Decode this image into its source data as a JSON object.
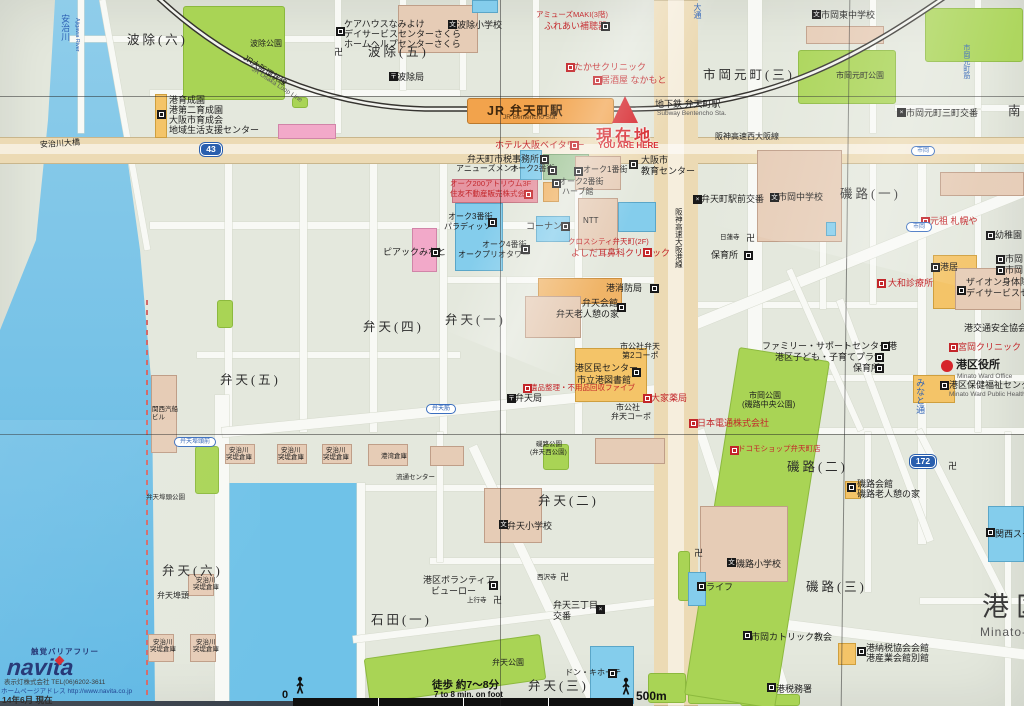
{
  "app": {
    "description": "Photographed local area guide map of JR Bentencho Station, Minato Ward, Osaka"
  },
  "marker": {
    "label": "現在地",
    "label_en": "YOU ARE HERE"
  },
  "station": {
    "name": "JR 弁天町駅",
    "name_en": "JR Bentencho Sta."
  },
  "districts": [
    {
      "t": "波除(六)",
      "x": 127,
      "y": 33
    },
    {
      "t": "波除(五)",
      "x": 368,
      "y": 45
    },
    {
      "t": "市岡元町(三)",
      "x": 703,
      "y": 68
    },
    {
      "t": "弁天(四)",
      "x": 363,
      "y": 320
    },
    {
      "t": "弁天(一)",
      "x": 445,
      "y": 313
    },
    {
      "t": "弁天(五)",
      "x": 220,
      "y": 373
    },
    {
      "t": "弁天(六)",
      "x": 162,
      "y": 564
    },
    {
      "t": "弁天(二)",
      "x": 538,
      "y": 494
    },
    {
      "t": "弁天(三)",
      "x": 528,
      "y": 679
    },
    {
      "t": "石田(一)",
      "x": 371,
      "y": 613
    },
    {
      "t": "磯路(一)",
      "x": 840,
      "y": 187
    },
    {
      "t": "磯路(二)",
      "x": 787,
      "y": 460
    },
    {
      "t": "磯路(三)",
      "x": 806,
      "y": 580
    },
    {
      "t": "南",
      "x": 1008,
      "y": 104
    }
  ],
  "ward": {
    "name": "港区",
    "name_en": "Minato-",
    "x": 982,
    "y": 592,
    "ex": 980,
    "ey": 626
  },
  "pois": [
    {
      "t": "港育成園",
      "x": 169,
      "y": 95
    },
    {
      "t": "港第二育成園",
      "x": 169,
      "y": 105
    },
    {
      "t": "大阪市育成会",
      "x": 169,
      "y": 115
    },
    {
      "t": "地域生活支援センター",
      "x": 169,
      "y": 125
    },
    {
      "t": "安治川大橋",
      "x": 40,
      "y": 140,
      "c": "s",
      "rot": -4
    },
    {
      "t": "波除公園",
      "x": 250,
      "y": 40,
      "c": "s"
    },
    {
      "t": "ケアハウスなみよけ",
      "x": 344,
      "y": 19
    },
    {
      "t": "デイサービスセンターさくら",
      "x": 344,
      "y": 29
    },
    {
      "t": "ホームヘルプセンターさくら",
      "x": 344,
      "y": 39
    },
    {
      "t": "波除小学校",
      "x": 457,
      "y": 20
    },
    {
      "t": "波除局",
      "x": 397,
      "y": 72
    },
    {
      "t": "アミューズMAKI(3階)",
      "x": 536,
      "y": 11,
      "c": "rs"
    },
    {
      "t": "ふれあい補聴器",
      "x": 544,
      "y": 21,
      "c": "r"
    },
    {
      "t": "たかせクリニック",
      "x": 574,
      "y": 62,
      "c": "r"
    },
    {
      "t": "居酒屋 なかもと",
      "x": 601,
      "y": 75,
      "c": "r"
    },
    {
      "t": "市岡東中学校",
      "x": 821,
      "y": 10
    },
    {
      "t": "市岡元町公園",
      "x": 836,
      "y": 72,
      "c": "s"
    },
    {
      "t": "市岡元町三町交番",
      "x": 906,
      "y": 108
    },
    {
      "t": "地下鉄 弁天町駅",
      "x": 655,
      "y": 99
    },
    {
      "t": "Subway Bentencho Sta.",
      "x": 657,
      "y": 110,
      "c": "e"
    },
    {
      "t": "阪神高速西大阪線",
      "x": 715,
      "y": 133,
      "c": "s"
    },
    {
      "t": "ホテル大阪ベイタワー",
      "x": 495,
      "y": 140,
      "c": "r"
    },
    {
      "t": "弁天町市税事務所",
      "x": 467,
      "y": 154
    },
    {
      "t": "アニューズメント",
      "x": 456,
      "y": 165,
      "c": "s"
    },
    {
      "t": "オーク2番街",
      "x": 510,
      "y": 165,
      "c": "s"
    },
    {
      "t": "オーク1番街",
      "x": 583,
      "y": 166,
      "c": "s"
    },
    {
      "t": "大阪市",
      "x": 641,
      "y": 155
    },
    {
      "t": "教育センター",
      "x": 641,
      "y": 166
    },
    {
      "t": "オーク200アトリウム3F",
      "x": 450,
      "y": 180,
      "c": "rs"
    },
    {
      "t": "住友不動産販売株式会社",
      "x": 450,
      "y": 190,
      "c": "rs"
    },
    {
      "t": "オーク2番街",
      "x": 559,
      "y": 178,
      "c": "s"
    },
    {
      "t": "ハーブ館",
      "x": 562,
      "y": 188,
      "c": "s"
    },
    {
      "t": "オーク3番街",
      "x": 448,
      "y": 213,
      "c": "s"
    },
    {
      "t": "パラディッソ",
      "x": 444,
      "y": 223,
      "c": "s"
    },
    {
      "t": "コーナン",
      "x": 526,
      "y": 221
    },
    {
      "t": "NTT",
      "x": 583,
      "y": 217,
      "c": "s"
    },
    {
      "t": "オーク4番街",
      "x": 482,
      "y": 241,
      "c": "s"
    },
    {
      "t": "オークプリオタワー",
      "x": 458,
      "y": 251,
      "c": "s"
    },
    {
      "t": "クロスシティ弁天町(2F)",
      "x": 568,
      "y": 238,
      "c": "rs"
    },
    {
      "t": "よしだ耳鼻科クリニック",
      "x": 571,
      "y": 248,
      "c": "r"
    },
    {
      "t": "ピアックみなと",
      "x": 383,
      "y": 247
    },
    {
      "t": "弁天町駅前交番",
      "x": 701,
      "y": 194
    },
    {
      "t": "市岡中学校",
      "x": 778,
      "y": 192
    },
    {
      "t": "日蓮寺",
      "x": 720,
      "y": 234,
      "c": "ss"
    },
    {
      "t": "保育所",
      "x": 711,
      "y": 250
    },
    {
      "t": "元祖 札幌や",
      "x": 930,
      "y": 216,
      "c": "r"
    },
    {
      "t": "幼稚園",
      "x": 995,
      "y": 230
    },
    {
      "t": "市岡",
      "x": 1005,
      "y": 254
    },
    {
      "t": "市岡",
      "x": 1005,
      "y": 265
    },
    {
      "t": "港居",
      "x": 940,
      "y": 262
    },
    {
      "t": "ザイオン身体障害",
      "x": 966,
      "y": 277
    },
    {
      "t": "デイサービスセ",
      "x": 966,
      "y": 288
    },
    {
      "t": "大和診療所",
      "x": 888,
      "y": 278,
      "c": "r"
    },
    {
      "t": "港交通安全協会",
      "x": 964,
      "y": 323
    },
    {
      "t": "宮岡クリニック",
      "x": 958,
      "y": 342,
      "c": "r"
    },
    {
      "t": "港区役所",
      "x": 956,
      "y": 359,
      "c": "b11"
    },
    {
      "t": "Minato Ward Office",
      "x": 957,
      "y": 373,
      "c": "e"
    },
    {
      "t": "港区保健福祉センター",
      "x": 949,
      "y": 380
    },
    {
      "t": "Minato Ward Public Health and Welf",
      "x": 949,
      "y": 391,
      "c": "e"
    },
    {
      "t": "港消防局",
      "x": 606,
      "y": 283
    },
    {
      "t": "弁天会館",
      "x": 582,
      "y": 298
    },
    {
      "t": "弁天老人憩の家",
      "x": 556,
      "y": 309
    },
    {
      "t": "市公社弁天",
      "x": 620,
      "y": 343,
      "c": "s"
    },
    {
      "t": "第2コーポ",
      "x": 622,
      "y": 352,
      "c": "s"
    },
    {
      "t": "港区民センター",
      "x": 575,
      "y": 363
    },
    {
      "t": "市立港図書館",
      "x": 577,
      "y": 375
    },
    {
      "t": "遺品整理・不用品回収ファイブ",
      "x": 530,
      "y": 384,
      "c": "rs"
    },
    {
      "t": "弁天局",
      "x": 515,
      "y": 393
    },
    {
      "t": "大家薬局",
      "x": 651,
      "y": 393,
      "c": "r"
    },
    {
      "t": "市公社",
      "x": 616,
      "y": 404,
      "c": "s"
    },
    {
      "t": "弁天コーポ",
      "x": 611,
      "y": 413,
      "c": "s"
    },
    {
      "t": "日本電通株式会社",
      "x": 697,
      "y": 418,
      "c": "r"
    },
    {
      "t": "ドコモショップ弁天町店",
      "x": 738,
      "y": 445,
      "c": "rs"
    },
    {
      "t": "ファミリー・サポートセンター港",
      "x": 762,
      "y": 341
    },
    {
      "t": "港区子ども・子育てプラザ",
      "x": 775,
      "y": 352
    },
    {
      "t": "保育所",
      "x": 853,
      "y": 363
    },
    {
      "t": "市岡公園",
      "x": 749,
      "y": 392,
      "c": "s"
    },
    {
      "t": "(磯路中央公園)",
      "x": 742,
      "y": 401,
      "c": "s"
    },
    {
      "t": "関西汽船",
      "x": 152,
      "y": 406,
      "c": "ss"
    },
    {
      "t": "ビル",
      "x": 152,
      "y": 414,
      "c": "ss"
    },
    {
      "t": "安治川",
      "x": 229,
      "y": 447,
      "c": "ss"
    },
    {
      "t": "突堤倉庫",
      "x": 226,
      "y": 454,
      "c": "ss"
    },
    {
      "t": "安治川",
      "x": 281,
      "y": 447,
      "c": "ss"
    },
    {
      "t": "突堤倉庫",
      "x": 278,
      "y": 454,
      "c": "ss"
    },
    {
      "t": "安治川",
      "x": 326,
      "y": 447,
      "c": "ss"
    },
    {
      "t": "突堤倉庫",
      "x": 323,
      "y": 454,
      "c": "ss"
    },
    {
      "t": "安治川",
      "x": 196,
      "y": 577,
      "c": "ss"
    },
    {
      "t": "突堤倉庫",
      "x": 193,
      "y": 584,
      "c": "ss"
    },
    {
      "t": "安治川",
      "x": 153,
      "y": 639,
      "c": "ss"
    },
    {
      "t": "突堤倉庫",
      "x": 150,
      "y": 646,
      "c": "ss"
    },
    {
      "t": "安治川",
      "x": 196,
      "y": 639,
      "c": "ss"
    },
    {
      "t": "突堤倉庫",
      "x": 193,
      "y": 646,
      "c": "ss"
    },
    {
      "t": "港湾倉庫",
      "x": 381,
      "y": 453,
      "c": "ss"
    },
    {
      "t": "流通センター",
      "x": 396,
      "y": 474,
      "c": "ss"
    },
    {
      "t": "弁天埠頭公園",
      "x": 146,
      "y": 494,
      "c": "ss"
    },
    {
      "t": "弁天埠頭",
      "x": 157,
      "y": 592,
      "c": "s"
    },
    {
      "t": "磯路公園",
      "x": 536,
      "y": 441,
      "c": "ss"
    },
    {
      "t": "(弁天西公園)",
      "x": 530,
      "y": 449,
      "c": "ss"
    },
    {
      "t": "弁天小学校",
      "x": 507,
      "y": 521
    },
    {
      "t": "港区ボランティア",
      "x": 423,
      "y": 575
    },
    {
      "t": "ビューロー",
      "x": 431,
      "y": 586
    },
    {
      "t": "上行寺",
      "x": 467,
      "y": 597,
      "c": "ss"
    },
    {
      "t": "西沢寺",
      "x": 537,
      "y": 574,
      "c": "ss"
    },
    {
      "t": "弁天三丁目",
      "x": 553,
      "y": 600
    },
    {
      "t": "交番",
      "x": 553,
      "y": 611
    },
    {
      "t": "弁天公園",
      "x": 492,
      "y": 659,
      "c": "s"
    },
    {
      "t": "ドン・キホーテ",
      "x": 565,
      "y": 669,
      "c": "s"
    },
    {
      "t": "磯路会館",
      "x": 857,
      "y": 479
    },
    {
      "t": "磯路老人憩の家",
      "x": 857,
      "y": 489
    },
    {
      "t": "磯路小学校",
      "x": 736,
      "y": 559
    },
    {
      "t": "ライフ",
      "x": 706,
      "y": 582
    },
    {
      "t": "市岡カトリック教会",
      "x": 751,
      "y": 632
    },
    {
      "t": "港納税協会会館",
      "x": 866,
      "y": 643
    },
    {
      "t": "港産業会館別館",
      "x": 866,
      "y": 653
    },
    {
      "t": "港税務署",
      "x": 776,
      "y": 684
    },
    {
      "t": "関西スーパー",
      "x": 995,
      "y": 529
    }
  ],
  "icons": [
    {
      "k": "f",
      "x": 157,
      "y": 110
    },
    {
      "k": "f",
      "x": 336,
      "y": 27
    },
    {
      "k": "sc",
      "x": 448,
      "y": 20
    },
    {
      "k": "po",
      "x": 389,
      "y": 72
    },
    {
      "k": "f",
      "x": 601,
      "y": 22
    },
    {
      "k": "fr",
      "x": 566,
      "y": 63
    },
    {
      "k": "fr",
      "x": 593,
      "y": 76
    },
    {
      "k": "mj",
      "x": 334,
      "y": 48
    },
    {
      "k": "sc",
      "x": 812,
      "y": 10
    },
    {
      "k": "pl",
      "x": 897,
      "y": 108
    },
    {
      "k": "fr",
      "x": 570,
      "y": 141
    },
    {
      "k": "f",
      "x": 540,
      "y": 155
    },
    {
      "k": "f",
      "x": 548,
      "y": 166
    },
    {
      "k": "f",
      "x": 574,
      "y": 167
    },
    {
      "k": "f",
      "x": 629,
      "y": 160
    },
    {
      "k": "fr",
      "x": 524,
      "y": 190
    },
    {
      "k": "f",
      "x": 552,
      "y": 179
    },
    {
      "k": "f",
      "x": 488,
      "y": 218
    },
    {
      "k": "f",
      "x": 561,
      "y": 222
    },
    {
      "k": "f",
      "x": 521,
      "y": 245
    },
    {
      "k": "fr",
      "x": 643,
      "y": 248
    },
    {
      "k": "f",
      "x": 431,
      "y": 248
    },
    {
      "k": "pl",
      "x": 693,
      "y": 195
    },
    {
      "k": "sc",
      "x": 770,
      "y": 193
    },
    {
      "k": "mj",
      "x": 746,
      "y": 234
    },
    {
      "k": "f",
      "x": 744,
      "y": 251
    },
    {
      "k": "fr",
      "x": 921,
      "y": 217
    },
    {
      "k": "f",
      "x": 986,
      "y": 231
    },
    {
      "k": "f",
      "x": 996,
      "y": 255
    },
    {
      "k": "f",
      "x": 996,
      "y": 266
    },
    {
      "k": "f",
      "x": 931,
      "y": 263
    },
    {
      "k": "f",
      "x": 957,
      "y": 286
    },
    {
      "k": "fr",
      "x": 877,
      "y": 279
    },
    {
      "k": "fr",
      "x": 949,
      "y": 343
    },
    {
      "k": "f",
      "x": 940,
      "y": 381
    },
    {
      "k": "f",
      "x": 650,
      "y": 284
    },
    {
      "k": "f",
      "x": 617,
      "y": 303
    },
    {
      "k": "f",
      "x": 632,
      "y": 368
    },
    {
      "k": "fr",
      "x": 523,
      "y": 384
    },
    {
      "k": "po",
      "x": 507,
      "y": 394
    },
    {
      "k": "fr",
      "x": 643,
      "y": 394
    },
    {
      "k": "fr",
      "x": 689,
      "y": 419
    },
    {
      "k": "fr",
      "x": 730,
      "y": 446
    },
    {
      "k": "f",
      "x": 881,
      "y": 342
    },
    {
      "k": "f",
      "x": 875,
      "y": 353
    },
    {
      "k": "f",
      "x": 875,
      "y": 364
    },
    {
      "k": "f",
      "x": 489,
      "y": 581
    },
    {
      "k": "mj",
      "x": 493,
      "y": 596
    },
    {
      "k": "mj",
      "x": 560,
      "y": 573
    },
    {
      "k": "pl",
      "x": 596,
      "y": 605
    },
    {
      "k": "f",
      "x": 608,
      "y": 669
    },
    {
      "k": "f",
      "x": 847,
      "y": 483
    },
    {
      "k": "sc",
      "x": 727,
      "y": 558
    },
    {
      "k": "mj",
      "x": 694,
      "y": 549
    },
    {
      "k": "f",
      "x": 697,
      "y": 582
    },
    {
      "k": "f",
      "x": 743,
      "y": 631
    },
    {
      "k": "f",
      "x": 857,
      "y": 647
    },
    {
      "k": "f",
      "x": 767,
      "y": 683
    },
    {
      "k": "f",
      "x": 986,
      "y": 528
    },
    {
      "k": "mj",
      "x": 948,
      "y": 462
    },
    {
      "k": "sc",
      "x": 499,
      "y": 520
    }
  ],
  "road_ovals": [
    {
      "t": "弁天埠頭前",
      "x": 174,
      "y": 437,
      "w": 42
    },
    {
      "t": "弁天筋",
      "x": 426,
      "y": 404,
      "w": 30
    },
    {
      "t": "市岡",
      "x": 911,
      "y": 146,
      "w": 24
    },
    {
      "t": "市岡",
      "x": 906,
      "y": 222,
      "w": 26
    }
  ],
  "route_shields": [
    {
      "t": "43",
      "x": 200,
      "y": 143,
      "w": 22
    },
    {
      "t": "172",
      "x": 910,
      "y": 455,
      "w": 26
    }
  ],
  "vlabels": [
    {
      "t": "安治川",
      "x": 60,
      "y": 14,
      "c": "bl",
      "s": 9
    },
    {
      "t": "Ajigawa River",
      "x": 74,
      "y": 18,
      "c": "bl",
      "s": 5.5,
      "up": false
    },
    {
      "t": "みなと通",
      "x": 915,
      "y": 378,
      "c": "bl",
      "s": 9
    },
    {
      "t": "大通",
      "x": 692,
      "y": 3,
      "c": "bl",
      "s": 8
    },
    {
      "t": "市岡元町筋",
      "x": 962,
      "y": 44,
      "c": "bl",
      "s": 7
    },
    {
      "t": "阪神高速大阪港線",
      "x": 674,
      "y": 208,
      "c": "",
      "s": 7.5
    }
  ],
  "rail_label": {
    "jp": "JR大阪環状線",
    "en": "JR Osaka Loop Line",
    "x": 246,
    "y": 54,
    "rot": 33
  },
  "scalebar": {
    "zero": "0",
    "distance": "500m",
    "walk_jp": "徒歩 約7〜8分",
    "walk_en": "7 to 8 min. on foot"
  },
  "footer": {
    "tagline": "触覚バリアフリー",
    "logo": "navita",
    "company": "表示灯株式会社 TEL(06)6202-3611",
    "url": "ホームページアドレス http://www.navita.co.jp",
    "date": "14年6月 現在"
  }
}
